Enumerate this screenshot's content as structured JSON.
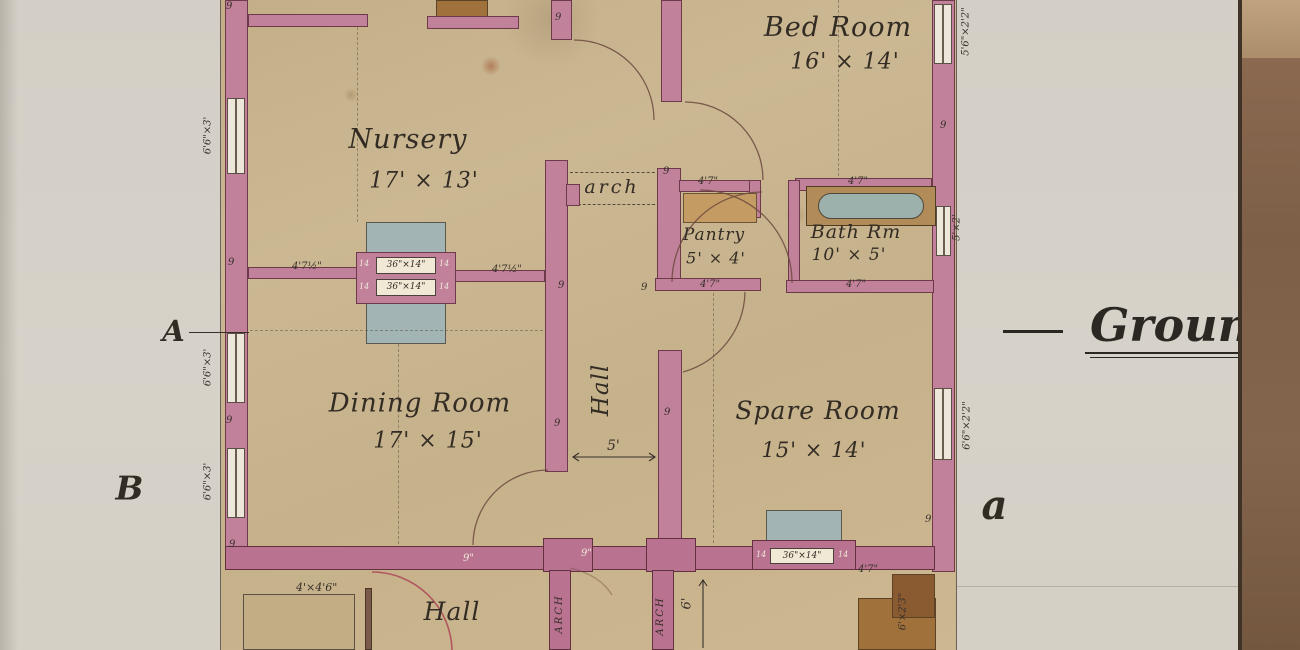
{
  "drawing": {
    "title_fragment": "Groun",
    "section_letters": {
      "A": "A",
      "B": "B",
      "a": "a"
    }
  },
  "rooms": {
    "bed": {
      "name": "Bed Room",
      "dims": "16' × 14'"
    },
    "nursery": {
      "name": "Nursery",
      "dims": "17' × 13'"
    },
    "pantry": {
      "name": "Pantry",
      "dims": "5' × 4'"
    },
    "bath": {
      "name": "Bath Rm",
      "dims": "10' × 5'"
    },
    "dining": {
      "name": "Dining Room",
      "dims": "17' × 15'"
    },
    "spare": {
      "name": "Spare Room",
      "dims": "15' × 14'"
    },
    "hall_main": {
      "name": "Hall"
    },
    "hall_entry": {
      "name": "Hall"
    }
  },
  "labels": {
    "arch": "arch",
    "porch_left": "ARCH",
    "porch_right": "ARCH"
  },
  "ann": {
    "nine": "9",
    "nine_in": "9\"",
    "d475": "4'7½\"",
    "d47": "4'7\"",
    "fp_open": "36\"×14\"",
    "jamb": "14",
    "win_663": "6'6\"×3'",
    "win_5622": "5'6\"×2'2\"",
    "win_52": "5'×2'",
    "win_6622": "6'6\"×2'2\"",
    "hall_width": "5'",
    "six": "6'",
    "steps": "6'×2'3\"",
    "porch_step": "4'×4'6\""
  }
}
